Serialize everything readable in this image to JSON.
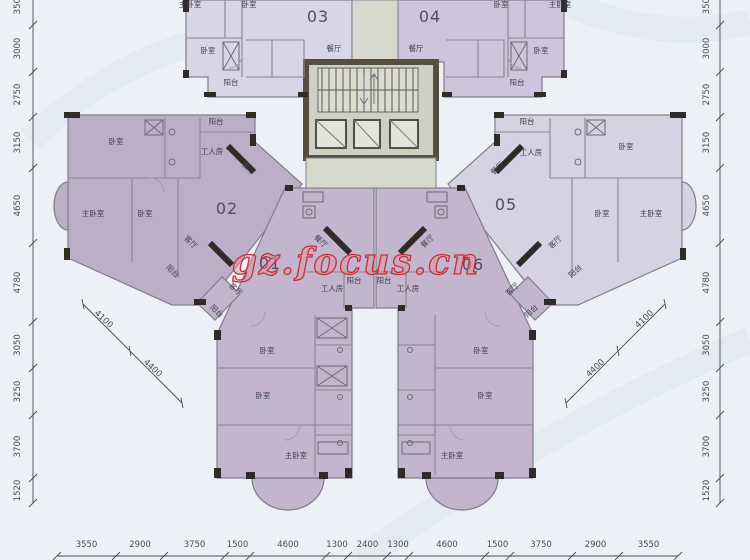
{
  "watermark": "gz.focus.cn",
  "unit_numbers": [
    {
      "text": "01",
      "x": 270,
      "y": 269
    },
    {
      "text": "02",
      "x": 227,
      "y": 214
    },
    {
      "text": "03",
      "x": 318,
      "y": 22
    },
    {
      "text": "04",
      "x": 430,
      "y": 22
    },
    {
      "text": "05",
      "x": 506,
      "y": 210
    },
    {
      "text": "06",
      "x": 473,
      "y": 270
    }
  ],
  "room_labels": [
    {
      "text": "主卧室",
      "x": 190,
      "y": 7,
      "rot": 0
    },
    {
      "text": "卧室",
      "x": 249,
      "y": 7,
      "rot": 0
    },
    {
      "text": "卧室",
      "x": 208,
      "y": 53,
      "rot": 0
    },
    {
      "text": "阳台",
      "x": 231,
      "y": 85,
      "rot": 0
    },
    {
      "text": "餐厅",
      "x": 334,
      "y": 51,
      "rot": 0
    },
    {
      "text": "餐厅",
      "x": 416,
      "y": 51,
      "rot": 0
    },
    {
      "text": "阳台",
      "x": 517,
      "y": 85,
      "rot": 0
    },
    {
      "text": "卧室",
      "x": 541,
      "y": 53,
      "rot": 0
    },
    {
      "text": "卧室",
      "x": 501,
      "y": 7,
      "rot": 0
    },
    {
      "text": "主卧室",
      "x": 560,
      "y": 7,
      "rot": 0
    },
    {
      "text": "阳台",
      "x": 216,
      "y": 124,
      "rot": 0
    },
    {
      "text": "卧室",
      "x": 116,
      "y": 144,
      "rot": 0
    },
    {
      "text": "工人房",
      "x": 212,
      "y": 154,
      "rot": 0
    },
    {
      "text": "餐厅",
      "x": 247,
      "y": 170,
      "rot": 43
    },
    {
      "text": "主卧室",
      "x": 93,
      "y": 216,
      "rot": 0
    },
    {
      "text": "卧室",
      "x": 145,
      "y": 216,
      "rot": 0
    },
    {
      "text": "客厅",
      "x": 189,
      "y": 244,
      "rot": 43
    },
    {
      "text": "阳台",
      "x": 171,
      "y": 273,
      "rot": 43
    },
    {
      "text": "阳台",
      "x": 527,
      "y": 124,
      "rot": 0
    },
    {
      "text": "卧室",
      "x": 626,
      "y": 149,
      "rot": 0
    },
    {
      "text": "工人房",
      "x": 531,
      "y": 155,
      "rot": 0
    },
    {
      "text": "餐厅",
      "x": 499,
      "y": 170,
      "rot": -43
    },
    {
      "text": "主卧室",
      "x": 651,
      "y": 216,
      "rot": 0
    },
    {
      "text": "卧室",
      "x": 602,
      "y": 216,
      "rot": 0
    },
    {
      "text": "客厅",
      "x": 557,
      "y": 244,
      "rot": -43
    },
    {
      "text": "阳台",
      "x": 577,
      "y": 273,
      "rot": -43
    },
    {
      "text": "餐厅",
      "x": 319,
      "y": 243,
      "rot": 43
    },
    {
      "text": "客厅",
      "x": 234,
      "y": 291,
      "rot": 43
    },
    {
      "text": "阳台",
      "x": 215,
      "y": 313,
      "rot": 43
    },
    {
      "text": "工人房",
      "x": 332,
      "y": 291,
      "rot": 0
    },
    {
      "text": "阳台",
      "x": 354,
      "y": 283,
      "rot": 0
    },
    {
      "text": "卧室",
      "x": 267,
      "y": 353,
      "rot": 0
    },
    {
      "text": "卧室",
      "x": 263,
      "y": 398,
      "rot": 0
    },
    {
      "text": "主卧室",
      "x": 296,
      "y": 458,
      "rot": 0
    },
    {
      "text": "餐厅",
      "x": 429,
      "y": 243,
      "rot": -43
    },
    {
      "text": "客厅",
      "x": 514,
      "y": 291,
      "rot": -43
    },
    {
      "text": "阳台",
      "x": 533,
      "y": 313,
      "rot": -43
    },
    {
      "text": "工人房",
      "x": 408,
      "y": 291,
      "rot": 0
    },
    {
      "text": "阳台",
      "x": 384,
      "y": 283,
      "rot": 0
    },
    {
      "text": "卧室",
      "x": 481,
      "y": 353,
      "rot": 0
    },
    {
      "text": "卧室",
      "x": 485,
      "y": 398,
      "rot": 0
    },
    {
      "text": "主卧室",
      "x": 452,
      "y": 458,
      "rot": 0
    }
  ],
  "dimensions": {
    "left": {
      "x": 33,
      "label_x": 20,
      "ticks": [
        -18,
        25,
        72,
        117,
        168,
        243,
        322,
        368,
        415,
        478,
        503
      ],
      "values": [
        "3500",
        "3000",
        "2750",
        "3150",
        "4650",
        "4780",
        "3050",
        "3250",
        "3700",
        "1520"
      ]
    },
    "right": {
      "x": 720,
      "label_x": 709,
      "ticks": [
        -18,
        25,
        72,
        117,
        168,
        243,
        322,
        368,
        415,
        478,
        503
      ],
      "values": [
        "3500",
        "3000",
        "2750",
        "3150",
        "4650",
        "4780",
        "3050",
        "3250",
        "3700",
        "1520"
      ]
    },
    "bottom": {
      "y": 556,
      "label_y": 547,
      "ticks": [
        57,
        116,
        164,
        225,
        250,
        326,
        348,
        387,
        409,
        485,
        510,
        572,
        619,
        678
      ],
      "values": [
        "3550",
        "2900",
        "3750",
        "1500",
        "4600",
        "1300",
        "2400",
        "1300",
        "4600",
        "1500",
        "3750",
        "2900",
        "3550"
      ]
    },
    "diagonals": [
      {
        "points": [
          [
            83,
            304
          ],
          [
            130,
            351
          ],
          [
            182,
            403
          ]
        ],
        "labels": [
          {
            "text": "4100",
            "x": 102,
            "y": 321,
            "rot": 43
          },
          {
            "text": "4400",
            "x": 151,
            "y": 370,
            "rot": 43
          }
        ]
      },
      {
        "points": [
          [
            665,
            304
          ],
          [
            618,
            351
          ],
          [
            566,
            403
          ]
        ],
        "labels": [
          {
            "text": "4100",
            "x": 646,
            "y": 321,
            "rot": -43
          },
          {
            "text": "4400",
            "x": 597,
            "y": 370,
            "rot": -43
          }
        ]
      }
    ]
  },
  "colors": {
    "background": "#edf1f7",
    "swirl": "#dde7f2",
    "unit_01": "#c2b5cd",
    "unit_02": "#bbafc7",
    "unit_03": "#d8d5e6",
    "unit_04": "#cdc5db",
    "unit_05": "#d5d2e4",
    "unit_06": "#c2b5cd",
    "core_fill": "#ccd1c3",
    "core_wall": "#55503d",
    "wall": "#827c8e",
    "wall_dark": "#2f2b28",
    "dim_text": "#4a4a4a",
    "room_text": "#3f3f4c",
    "watermark_stroke": "#c5303f",
    "watermark_fill": "#e2939e"
  }
}
